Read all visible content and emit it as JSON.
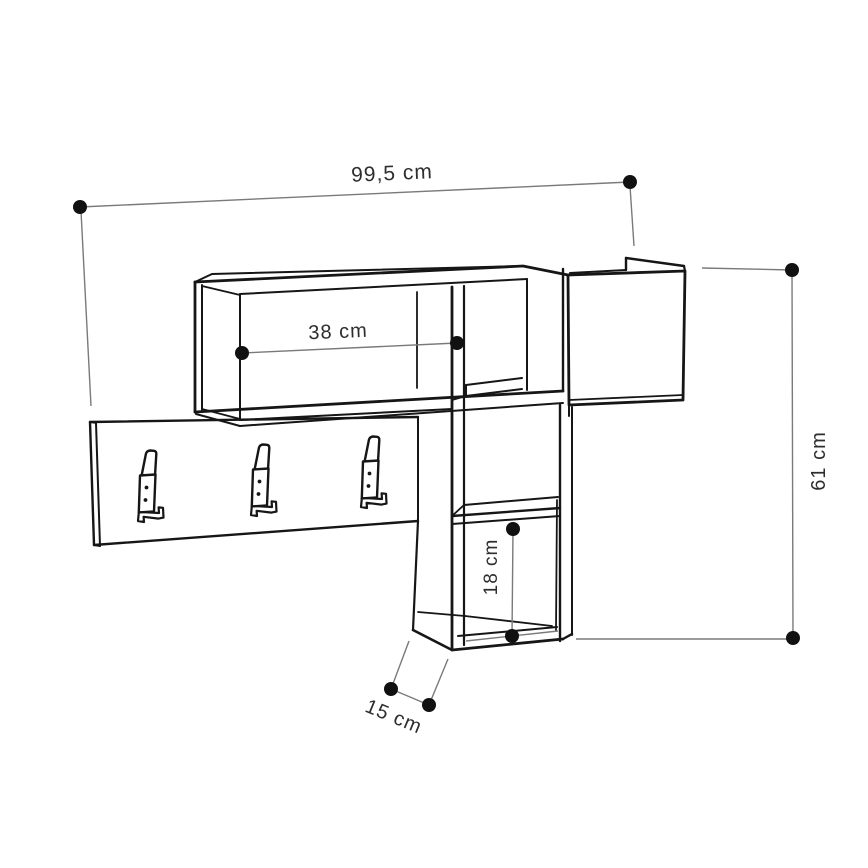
{
  "figure": {
    "type": "furniture-dimension-diagram",
    "subject": "wall-mounted coat rack with shelf compartments, storage box and three double hooks",
    "background_color": "#ffffff",
    "outline_color": "#161616",
    "dimension_line_color": "#7a7a7a",
    "label_color": "#2e2e2e",
    "hook_count": 3
  },
  "dimensions": {
    "overall_width": {
      "label": "99,5 cm",
      "value": "99,5",
      "unit": "cm"
    },
    "overall_height": {
      "label": "61 cm",
      "value": "61",
      "unit": "cm"
    },
    "shelf_width": {
      "label": "38 cm",
      "value": "38",
      "unit": "cm"
    },
    "cube_height": {
      "label": "18 cm",
      "value": "18",
      "unit": "cm"
    },
    "depth": {
      "label": "15 cm",
      "value": "15",
      "unit": "cm"
    }
  }
}
